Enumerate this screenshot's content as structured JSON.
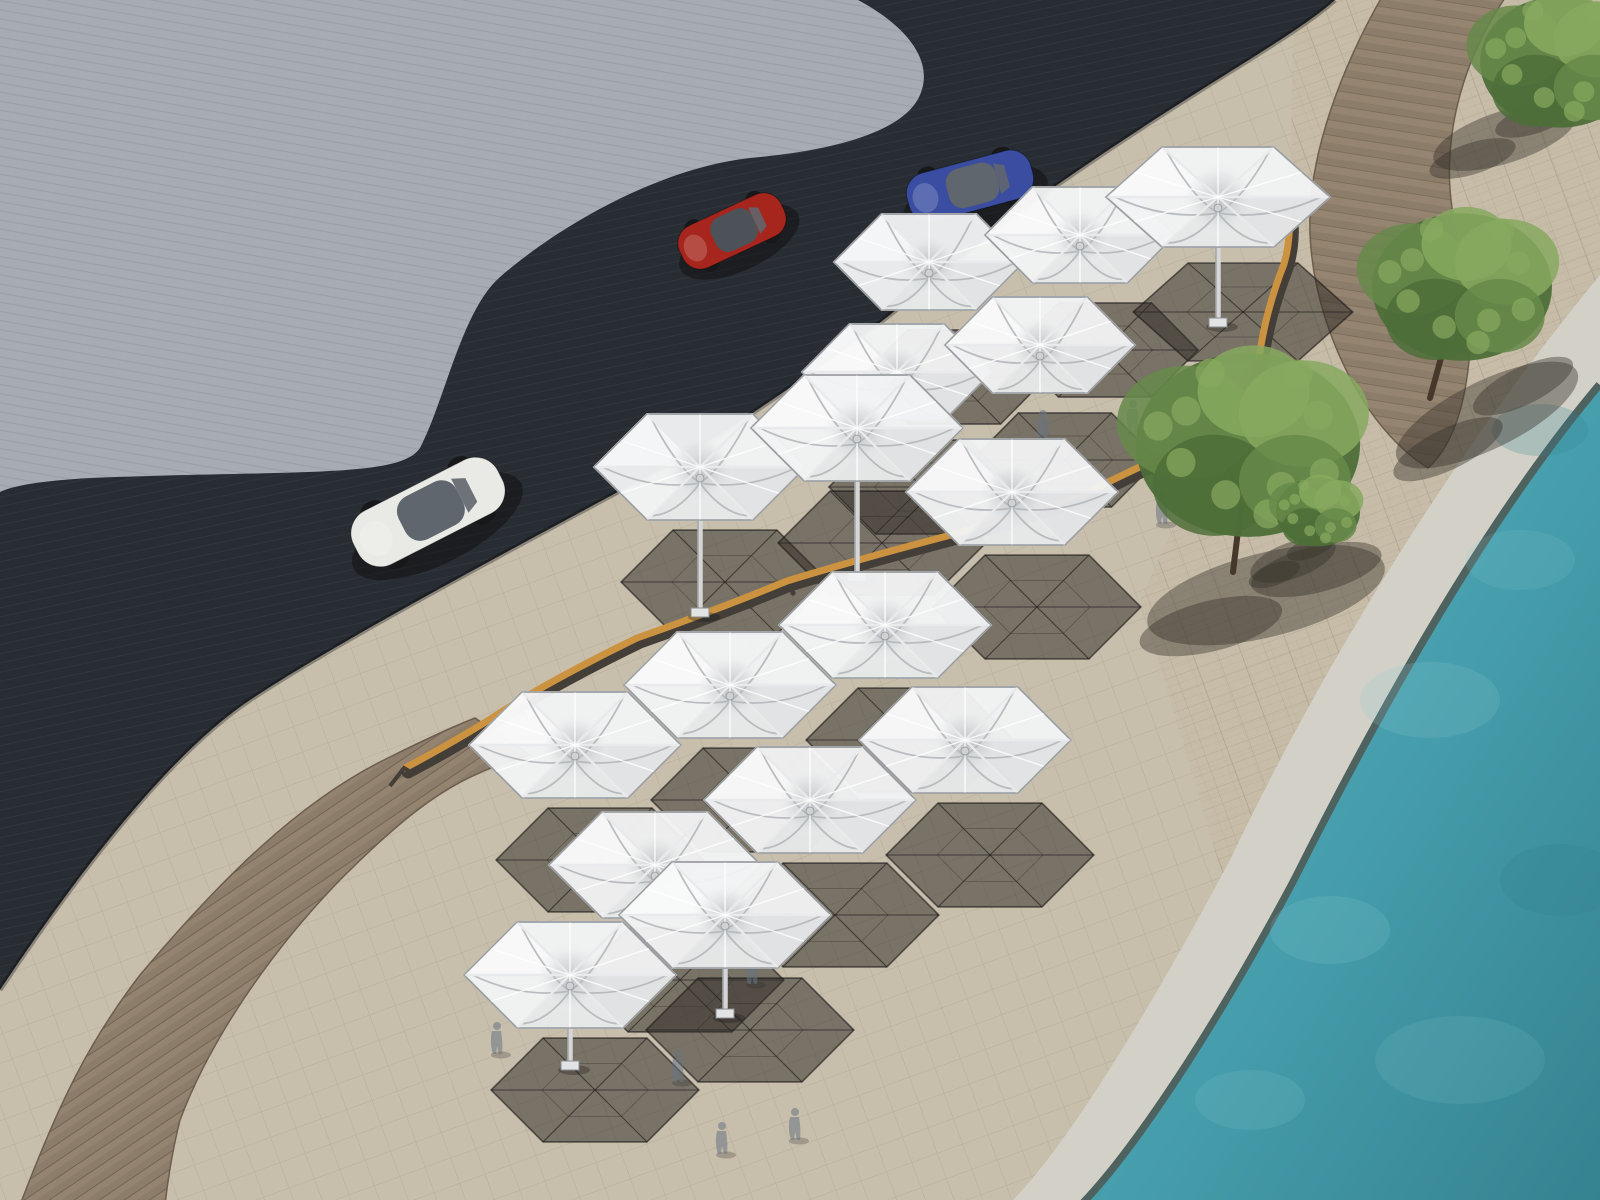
{
  "meta": {
    "description": "Aerial 3D architectural rendering of a waterfront promenade: modular white hexagonal umbrella canopies on a beige paved esplanade between a dark asphalt road and a turquoise pool, with curved wooden boardwalks, a long curved timber bench, trees and three parked/driving cars.",
    "render_style": "photorealistic CG perspective from above",
    "no_text_visible": true
  },
  "palette": {
    "plaza": "#a6acb1",
    "plaza_streak": "rgba(55,65,78,0.10)",
    "road": "#282c33",
    "road_streak": "rgba(255,255,255,0.045)",
    "pave": "#c8beac",
    "pave_line": "rgba(90,80,62,0.16)",
    "brick": "#c4b9a6",
    "brick_line": "rgba(100,88,70,0.20)",
    "wood": "#8c7c6a",
    "wood_dark": "#6c5d4d",
    "wood_light": "#9b8b75",
    "coping": "#d3d1c7",
    "coping_edge": "#4e6260",
    "water": "#49a2b0",
    "water_deep": "#358291",
    "water_light": "#8ecdd4",
    "membrane": "#f2f3f4",
    "membrane_shade": "#d7d9db",
    "membrane_bright": "#ffffff",
    "strut": "#b4b7ba",
    "strut_light": "#e9eaeb",
    "rim": "#94979a",
    "shadow_fill": "rgba(48,44,39,0.52)",
    "shadow_line": "rgba(28,26,24,0.62)",
    "bench_wood": "#cb9240",
    "bench_dark": "#433e37",
    "tree_mid": "#66894a",
    "tree_light": "#87a95f",
    "tree_dark": "#4d6e38",
    "trunk": "#46392c",
    "tree_shadow": "rgba(55,50,44,0.42)",
    "car_red": "#a6261d",
    "car_red_hi": "#c9402e",
    "car_white": "#e9e9e6",
    "car_blue": "#3a4da0",
    "car_roof": "#4d5258",
    "glass": "#60666d",
    "mast": "#d5d6d8",
    "ghost": "rgba(104,117,131,0.55)"
  },
  "scene": {
    "areas": [
      {
        "id": "plaza",
        "label": "textured light-gray plaza (top left)"
      },
      {
        "id": "road",
        "label": "dark asphalt road band"
      },
      {
        "id": "promenade",
        "label": "beige paved promenade with diagonal joint grid"
      },
      {
        "id": "brick-strip",
        "label": "brick paving along the pool side"
      },
      {
        "id": "boardwalk-lower",
        "label": "curved wooden boardwalk, bottom left"
      },
      {
        "id": "boardwalk-upper",
        "label": "curved wooden boardwalk, top right"
      },
      {
        "id": "pool-coping",
        "label": "light stone pool edge"
      },
      {
        "id": "water",
        "label": "turquoise pool water, bottom right"
      }
    ],
    "canopy_geometry": {
      "rx": 106,
      "ry": 53,
      "single_rx": 112,
      "single_ry": 50,
      "a_rx": 95,
      "a_ry": 48
    },
    "shadow_offset": {
      "dx": 25,
      "dy": 115
    },
    "canopies": [
      {
        "id": "A1",
        "cx": 929,
        "cy": 262,
        "kind": "a"
      },
      {
        "id": "A2",
        "cx": 1080,
        "cy": 235,
        "kind": "a"
      },
      {
        "id": "A3",
        "cx": 897,
        "cy": 372,
        "kind": "a"
      },
      {
        "id": "A4",
        "cx": 1040,
        "cy": 345,
        "kind": "a"
      },
      {
        "id": "S1",
        "cx": 1218,
        "cy": 197,
        "kind": "single",
        "mast": 125
      },
      {
        "id": "B1",
        "cx": 700,
        "cy": 467,
        "kind": "std",
        "mast": 145
      },
      {
        "id": "B2",
        "cx": 857,
        "cy": 428,
        "kind": "std",
        "mast": 148
      },
      {
        "id": "B3",
        "cx": 1012,
        "cy": 492,
        "kind": "std"
      },
      {
        "id": "C1",
        "cx": 575,
        "cy": 745,
        "kind": "std"
      },
      {
        "id": "C2",
        "cx": 730,
        "cy": 685,
        "kind": "std"
      },
      {
        "id": "C3",
        "cx": 885,
        "cy": 625,
        "kind": "std"
      },
      {
        "id": "C4",
        "cx": 655,
        "cy": 865,
        "kind": "std"
      },
      {
        "id": "C5",
        "cx": 810,
        "cy": 800,
        "kind": "std"
      },
      {
        "id": "C6",
        "cx": 965,
        "cy": 740,
        "kind": "std"
      },
      {
        "id": "C7",
        "cx": 570,
        "cy": 975,
        "kind": "std",
        "mast": 90
      },
      {
        "id": "C8",
        "cx": 725,
        "cy": 915,
        "kind": "std",
        "mast": 98
      }
    ],
    "cars": [
      {
        "id": "red-sports-car",
        "color_key": "car_red",
        "cx": 732,
        "cy": 231,
        "len": 112,
        "wid": 46,
        "rot": -25,
        "roof": "car_roof"
      },
      {
        "id": "white-sedan",
        "color_key": "car_white",
        "cx": 428,
        "cy": 512,
        "len": 162,
        "wid": 60,
        "rot": -27,
        "roof": "glass"
      },
      {
        "id": "blue-car",
        "color_key": "car_blue",
        "cx": 970,
        "cy": 186,
        "len": 128,
        "wid": 50,
        "rot": -15,
        "roof": "glass"
      }
    ],
    "trees": [
      {
        "id": "tree-top-right-corner",
        "cx": 1560,
        "cy": 62,
        "r": 80,
        "shadow": {
          "dx": -55,
          "dy": 75,
          "rx": 75,
          "ry": 26,
          "rot": -18
        }
      },
      {
        "id": "tree-upper-right",
        "cx": 1462,
        "cy": 287,
        "r": 90,
        "trunk": [
          1430,
          398,
          1450,
          325
        ],
        "shadow": {
          "dx": 25,
          "dy": 128,
          "rx": 100,
          "ry": 34,
          "rot": -26
        }
      },
      {
        "id": "tree-large-center",
        "cx": 1248,
        "cy": 445,
        "r": 112,
        "trunk": [
          1233,
          572,
          1242,
          498
        ],
        "shadow": {
          "dx": 18,
          "dy": 150,
          "rx": 122,
          "ry": 42,
          "rot": -14
        }
      },
      {
        "id": "tree-small-pool-edge",
        "cx": 1318,
        "cy": 512,
        "r": 42,
        "shadow": {
          "dx": -25,
          "dy": 48,
          "rx": 45,
          "ry": 18,
          "rot": -20
        }
      }
    ],
    "people": [
      {
        "x": 1133,
        "y": 430
      },
      {
        "x": 1043,
        "y": 440
      },
      {
        "x": 1162,
        "y": 522
      },
      {
        "x": 678,
        "y": 1080
      },
      {
        "x": 722,
        "y": 1152
      },
      {
        "x": 752,
        "y": 982
      },
      {
        "x": 497,
        "y": 1052
      },
      {
        "x": 795,
        "y": 1138
      }
    ],
    "bench": {
      "label": "long curved timber bench with dark back rail",
      "points": [
        [
          408,
          772
        ],
        [
          520,
          706
        ],
        [
          640,
          642
        ],
        [
          790,
          585
        ],
        [
          950,
          540
        ],
        [
          1090,
          497
        ],
        [
          1195,
          448
        ],
        [
          1262,
          362
        ],
        [
          1287,
          268
        ],
        [
          1291,
          212
        ]
      ]
    }
  }
}
